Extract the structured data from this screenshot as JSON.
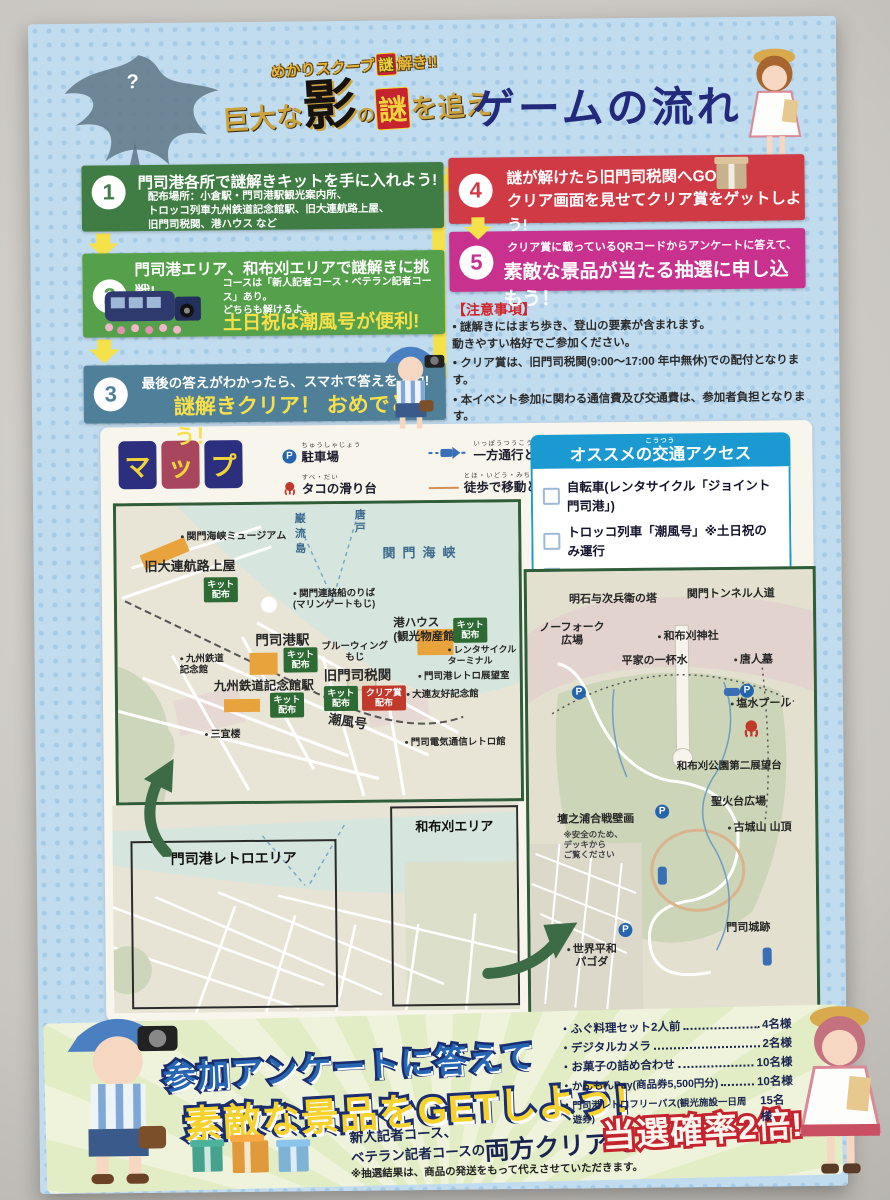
{
  "header": {
    "arc_pre": "めかりスクープ",
    "arc_nazo": "謎",
    "arc_post": "解き!!",
    "logo_pre": "巨大な",
    "logo_kage": "影",
    "logo_no": "の",
    "logo_nazo": "謎",
    "logo_post": "を追え",
    "title": "ゲームの流れ",
    "monster_mark": "?"
  },
  "steps": [
    {
      "num": "1",
      "headline": "門司港各所で謎解きキットを手に入れよう!",
      "body": "配布場所：小倉駅・門司港駅観光案内所、\nトロッコ列車九州鉄道記念館駅、旧大連航路上屋、\n旧門司税関、港ハウス など"
    },
    {
      "num": "2",
      "headline": "門司港エリア、和布刈エリアで謎解きに挑戦!",
      "body": "コースは「新人記者コース・ベテラン記者コース」あり。\nどちらも解けるよ。",
      "highlight": "土日祝は潮風号が便利!"
    },
    {
      "num": "3",
      "headline": "最後の答えがわかったら、スマホで答えを入力!",
      "highlight": "謎解きクリア！ おめでとう！"
    },
    {
      "num": "4",
      "headline": "謎が解けたら旧門司税関へGO\nクリア画面を見せてクリア賞をゲットしよう!"
    },
    {
      "num": "5",
      "body": "クリア賞に載っているQRコードからアンケートに答えて、",
      "highlight": "素敵な景品が当たる抽選に申し込もう！"
    }
  ],
  "notes": {
    "title": "【注意事項】",
    "items": [
      "謎解きにはまち歩き、登山の要素が含まれます。\n動きやすい格好でご参加ください。",
      "クリア賞は、旧門司税関(9:00～17:00 年中無休)での配付となります。",
      "本イベント参加に関わる通信費及び交通費は、参加者負担となります。",
      "移動の際には、交通ルールを守り、安全を心がけてください。"
    ]
  },
  "map": {
    "title_chars": [
      "マ",
      "ッ",
      "プ"
    ],
    "marker_p": "P",
    "badges": {
      "kit": "キット配布",
      "clear": "クリア賞配布"
    },
    "legend": [
      {
        "ruby": "ちゅうしゃじょう",
        "label": "駐車場"
      },
      {
        "ruby": "すべ・だい",
        "label": "タコの滑り台"
      },
      {
        "ruby": "いっぽうつうこう・しゃどう",
        "label": "一方通行となる車道"
      },
      {
        "ruby": "とほ・いどう・みち",
        "label": "徒歩で移動となる道"
      }
    ],
    "access": {
      "ruby": "こうつう",
      "title": "オススメの交通アクセス",
      "items": [
        "自転車(レンタサイクル「ジョイント門司港」)",
        "トロッコ列車「潮風号」※土日祝のみ運行",
        "バス"
      ]
    },
    "left": {
      "museum": "関門海峡ミュージアム",
      "dairen": "旧大連航路上屋",
      "ganryujima": "巌流島",
      "karato": "唐戸",
      "sea": "関門海峡",
      "ferry": "関門連絡船のりば\n(マリンゲートもじ)",
      "minato_house": "港ハウス\n(観光物産館)",
      "mojiko_sta": "門司港駅",
      "bluewing": "ブルーウィング\nもじ",
      "rentacycle": "レンタサイクル\nターミナル",
      "kyushu_museum": "九州鉄道\n記念館",
      "kinenkan_sta": "九州鉄道記念館駅",
      "customs": "旧門司税関",
      "retro_tenbo": "門司港レトロ展望室",
      "dalian": "大連友好記念館",
      "sangiro": "三宜楼",
      "shiokaze": "潮風号",
      "denki": "門司電気通信レトロ館"
    },
    "lower": {
      "retro_area": "門司港レトロエリア",
      "mekari_area": "和布刈エリア"
    },
    "right": {
      "norfolk": "ノーフォーク\n広場",
      "akashi": "明石与次兵衛の塔",
      "tunnel": "関門トンネル人道",
      "shrine": "和布刈神社",
      "heike": "平家の一杯水",
      "toujinbaka": "唐人墓",
      "pool": "塩水プール",
      "tenbodai2": "和布刈公園第二展望台",
      "seikadai": "聖火台広場",
      "hekiga": "壇之浦合戦壁画",
      "hekiga_note": "※安全のため、\nデッキから\nご覧ください",
      "kojosan": "古城山 山頂",
      "mojijo": "門司城跡",
      "pagoda": "世界平和\nパゴダ"
    }
  },
  "footer": {
    "line1": "参加アンケートに答えて",
    "line2": "素敵な景品をGETしよう!",
    "course1": "新人記者コース、",
    "course2": "ベテラン記者コースの",
    "both": "両方クリアで",
    "double": "当選確率2倍!",
    "disclaimer": "※抽選結果は、商品の発送をもって代えさせていただきます。",
    "prizes": [
      {
        "name": "ふぐ料理セット2人前",
        "count": "4名様"
      },
      {
        "name": "デジタルカメラ",
        "count": "2名様"
      },
      {
        "name": "お菓子の詰め合わせ",
        "count": "10名様"
      },
      {
        "name": "かんもんPay(商品券5,500円分)",
        "count": "10名様"
      },
      {
        "name": "門司港レトロフリーパス(観光施設一日周遊券)",
        "count": "15名様"
      }
    ]
  },
  "colors": {
    "step1": "#3f7d44",
    "step2": "#55a04b",
    "step3": "#4f7f99",
    "step4": "#cf3a45",
    "step5": "#c9318e",
    "accent_yellow": "#f5e14a",
    "map_frame": "#2f5d3a",
    "access_blue": "#1b9ad2",
    "navy": "#232a7c",
    "note_red": "#d2232a",
    "badge_green": "#2e6b34",
    "badge_red": "#c0392b"
  }
}
